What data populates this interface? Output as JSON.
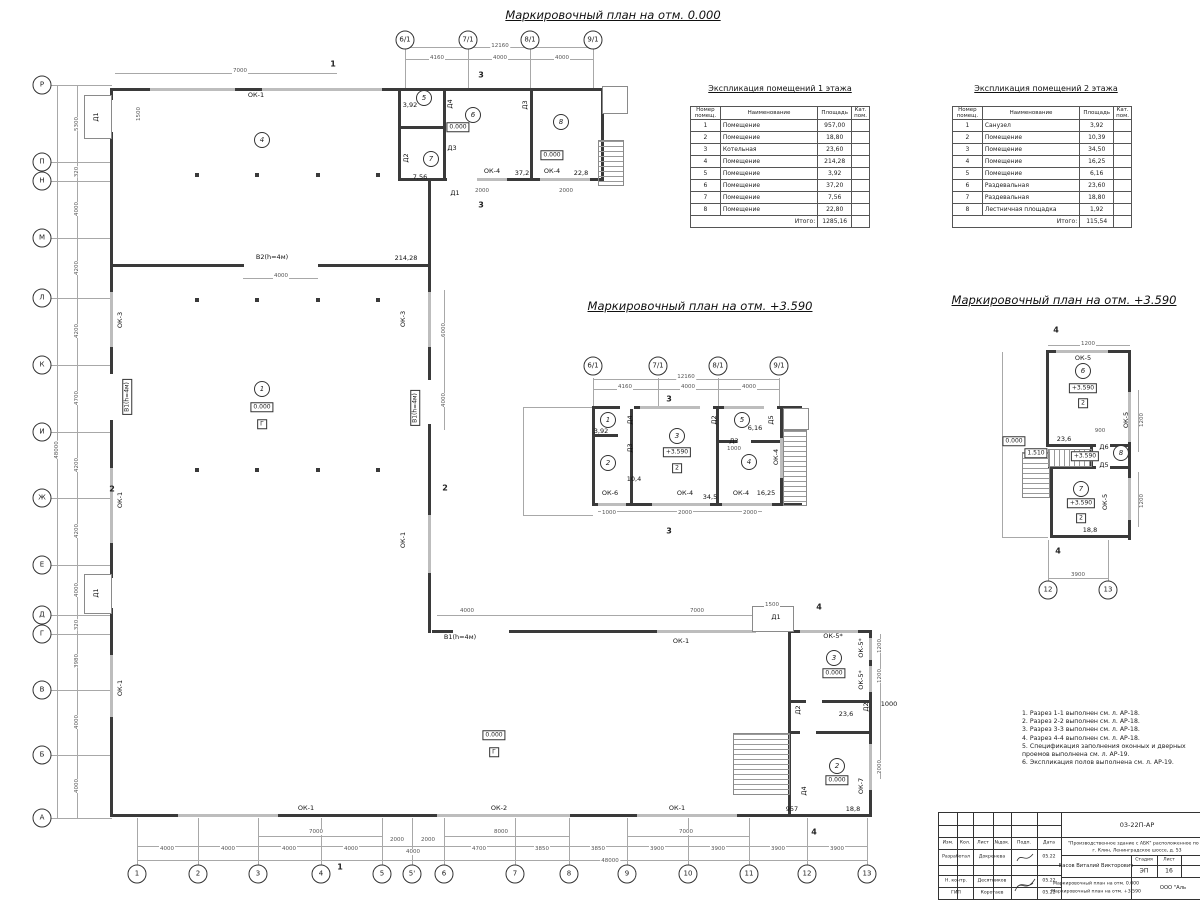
{
  "colors": {
    "wall": "#3a3a3a",
    "thin_line": "#a8a8a8",
    "window": "#bdbdbd",
    "dim_text": "#555555"
  },
  "plan_titles": {
    "main": "Маркировочный план на отм. 0.000",
    "mid": "Маркировочный план на отм. +3.590",
    "right": "Маркировочный план на отм. +3.590"
  },
  "axes": {
    "left_rows": [
      {
        "t": "Р",
        "x": 42,
        "y": 85
      },
      {
        "t": "П",
        "x": 42,
        "y": 162
      },
      {
        "t": "Н",
        "x": 42,
        "y": 181
      },
      {
        "t": "М",
        "x": 42,
        "y": 238
      },
      {
        "t": "Л",
        "x": 42,
        "y": 298
      },
      {
        "t": "К",
        "x": 42,
        "y": 365
      },
      {
        "t": "И",
        "x": 42,
        "y": 432
      },
      {
        "t": "Ж",
        "x": 42,
        "y": 498
      },
      {
        "t": "Е",
        "x": 42,
        "y": 565
      },
      {
        "t": "Д",
        "x": 42,
        "y": 615
      },
      {
        "t": "Г",
        "x": 42,
        "y": 634
      },
      {
        "t": "В",
        "x": 42,
        "y": 690
      },
      {
        "t": "Б",
        "x": 42,
        "y": 755
      },
      {
        "t": "А",
        "x": 42,
        "y": 818
      }
    ],
    "bottom_cols": [
      {
        "t": "1",
        "x": 137,
        "y": 874
      },
      {
        "t": "2",
        "x": 198,
        "y": 874
      },
      {
        "t": "3",
        "x": 258,
        "y": 874
      },
      {
        "t": "4",
        "x": 321,
        "y": 874
      },
      {
        "t": "5",
        "x": 382,
        "y": 874
      },
      {
        "t": "5'",
        "x": 412,
        "y": 874
      },
      {
        "t": "6",
        "x": 444,
        "y": 874
      },
      {
        "t": "7",
        "x": 515,
        "y": 874
      },
      {
        "t": "8",
        "x": 569,
        "y": 874
      },
      {
        "t": "9",
        "x": 627,
        "y": 874
      },
      {
        "t": "10",
        "x": 688,
        "y": 874
      },
      {
        "t": "11",
        "x": 749,
        "y": 874
      },
      {
        "t": "12",
        "x": 807,
        "y": 874
      },
      {
        "t": "13",
        "x": 867,
        "y": 874
      }
    ],
    "top_main": [
      {
        "t": "6/1",
        "x": 405,
        "y": 40
      },
      {
        "t": "7/1",
        "x": 468,
        "y": 40
      },
      {
        "t": "8/1",
        "x": 530,
        "y": 40
      },
      {
        "t": "9/1",
        "x": 593,
        "y": 40
      }
    ],
    "top_mid": [
      {
        "t": "6/1",
        "x": 593,
        "y": 366
      },
      {
        "t": "7/1",
        "x": 658,
        "y": 366
      },
      {
        "t": "8/1",
        "x": 718,
        "y": 366
      },
      {
        "t": "9/1",
        "x": 779,
        "y": 366
      }
    ],
    "right_bottom": [
      {
        "t": "12",
        "x": 1048,
        "y": 590
      },
      {
        "t": "13",
        "x": 1108,
        "y": 590
      }
    ]
  },
  "marks": {
    "labels_h": [
      {
        "t": "ОК-1",
        "x": 256,
        "y": 95
      },
      {
        "t": "В2(h=4м)",
        "x": 272,
        "y": 257
      },
      {
        "t": "214,28",
        "x": 406,
        "y": 258
      },
      {
        "t": "В1(h=4м)",
        "x": 460,
        "y": 637
      },
      {
        "t": "ОК-1",
        "x": 681,
        "y": 641
      },
      {
        "t": "ОК-1",
        "x": 306,
        "y": 808
      },
      {
        "t": "ОК-2",
        "x": 499,
        "y": 808
      },
      {
        "t": "ОК-1",
        "x": 677,
        "y": 808
      },
      {
        "t": "ОК-4",
        "x": 492,
        "y": 171
      },
      {
        "t": "37,2",
        "x": 522,
        "y": 173
      },
      {
        "t": "ОК-4",
        "x": 552,
        "y": 171
      },
      {
        "t": "22,8",
        "x": 581,
        "y": 173
      },
      {
        "t": "3,92",
        "x": 410,
        "y": 105
      },
      {
        "t": "7,56",
        "x": 420,
        "y": 177
      },
      {
        "t": "Д3",
        "x": 452,
        "y": 148
      },
      {
        "t": "Д1",
        "x": 455,
        "y": 193
      },
      {
        "t": "ОК-5*",
        "x": 833,
        "y": 636
      },
      {
        "t": "23,6",
        "x": 846,
        "y": 714
      },
      {
        "t": "18,8",
        "x": 853,
        "y": 809
      },
      {
        "t": "957",
        "x": 792,
        "y": 809
      },
      {
        "t": "Д1",
        "x": 776,
        "y": 617
      },
      {
        "t": "3,92",
        "x": 601,
        "y": 431
      },
      {
        "t": "10,4",
        "x": 634,
        "y": 479
      },
      {
        "t": "34,5",
        "x": 710,
        "y": 497
      },
      {
        "t": "ОК-6",
        "x": 610,
        "y": 493
      },
      {
        "t": "ОК-4",
        "x": 685,
        "y": 493
      },
      {
        "t": "ОК-4",
        "x": 741,
        "y": 493
      },
      {
        "t": "16,25",
        "x": 766,
        "y": 493
      },
      {
        "t": "6,16",
        "x": 755,
        "y": 428
      },
      {
        "t": "Д3",
        "x": 734,
        "y": 441
      },
      {
        "t": "ОК-5",
        "x": 1083,
        "y": 358
      },
      {
        "t": "23,6",
        "x": 1064,
        "y": 439
      },
      {
        "t": "Д6",
        "x": 1104,
        "y": 447
      },
      {
        "t": "Д5",
        "x": 1104,
        "y": 465
      },
      {
        "t": "18,8",
        "x": 1090,
        "y": 530
      },
      {
        "t": "1000",
        "x": 889,
        "y": 704
      }
    ],
    "labels_v": [
      {
        "t": "Д1",
        "x": 96,
        "y": 117
      },
      {
        "t": "ОК-3",
        "x": 120,
        "y": 320
      },
      {
        "t": "ОК-1",
        "x": 120,
        "y": 500
      },
      {
        "t": "Д1",
        "x": 96,
        "y": 593
      },
      {
        "t": "ОК-1",
        "x": 120,
        "y": 688
      },
      {
        "t": "ОК-3",
        "x": 403,
        "y": 319
      },
      {
        "t": "ОК-1",
        "x": 403,
        "y": 540
      },
      {
        "t": "Д4",
        "x": 450,
        "y": 104
      },
      {
        "t": "Д3",
        "x": 525,
        "y": 105
      },
      {
        "t": "Д2",
        "x": 406,
        "y": 158
      },
      {
        "t": "ОК-5*",
        "x": 861,
        "y": 648
      },
      {
        "t": "ОК-5*",
        "x": 861,
        "y": 680
      },
      {
        "t": "Д2",
        "x": 798,
        "y": 710
      },
      {
        "t": "Д2",
        "x": 866,
        "y": 707
      },
      {
        "t": "ОК-7",
        "x": 861,
        "y": 786
      },
      {
        "t": "Д4",
        "x": 804,
        "y": 791
      },
      {
        "t": "Д4",
        "x": 630,
        "y": 420
      },
      {
        "t": "Д3",
        "x": 630,
        "y": 448
      },
      {
        "t": "Д2",
        "x": 714,
        "y": 420
      },
      {
        "t": "Д5",
        "x": 771,
        "y": 420
      },
      {
        "t": "ОК-4",
        "x": 776,
        "y": 457
      },
      {
        "t": "ОК-5",
        "x": 1126,
        "y": 420
      },
      {
        "t": "ОК-5",
        "x": 1105,
        "y": 502
      }
    ],
    "boxes": [
      {
        "t": "0.000",
        "x": 262,
        "y": 407
      },
      {
        "t": "Г",
        "x": 262,
        "y": 424
      },
      {
        "t": "0.000",
        "x": 494,
        "y": 735
      },
      {
        "t": "Г",
        "x": 494,
        "y": 752
      },
      {
        "t": "0.000",
        "x": 458,
        "y": 127
      },
      {
        "t": "0.000",
        "x": 552,
        "y": 155
      },
      {
        "t": "0.000",
        "x": 834,
        "y": 673
      },
      {
        "t": "0.000",
        "x": 837,
        "y": 780
      },
      {
        "t": "+3.590",
        "x": 677,
        "y": 452
      },
      {
        "t": "2",
        "x": 677,
        "y": 468
      },
      {
        "t": "+3.590",
        "x": 1083,
        "y": 388
      },
      {
        "t": "2",
        "x": 1083,
        "y": 403
      },
      {
        "t": "0.000",
        "x": 1014,
        "y": 441
      },
      {
        "t": "1.510",
        "x": 1036,
        "y": 453
      },
      {
        "t": "+3.590",
        "x": 1085,
        "y": 456
      },
      {
        "t": "+3.590",
        "x": 1081,
        "y": 503
      },
      {
        "t": "2",
        "x": 1081,
        "y": 518
      }
    ],
    "vboxes": [
      {
        "t": "В1(h=4м)",
        "x": 127,
        "y": 397
      },
      {
        "t": "В1(h=4м)",
        "x": 415,
        "y": 408
      }
    ],
    "rooms": [
      {
        "t": "4",
        "x": 262,
        "y": 140
      },
      {
        "t": "1",
        "x": 262,
        "y": 389
      },
      {
        "t": "5",
        "x": 424,
        "y": 98
      },
      {
        "t": "6",
        "x": 473,
        "y": 115
      },
      {
        "t": "7",
        "x": 431,
        "y": 159
      },
      {
        "t": "8",
        "x": 561,
        "y": 122
      },
      {
        "t": "3",
        "x": 834,
        "y": 658
      },
      {
        "t": "2",
        "x": 837,
        "y": 766
      },
      {
        "t": "1",
        "x": 608,
        "y": 420
      },
      {
        "t": "2",
        "x": 608,
        "y": 463
      },
      {
        "t": "3",
        "x": 677,
        "y": 436
      },
      {
        "t": "4",
        "x": 749,
        "y": 462
      },
      {
        "t": "5",
        "x": 742,
        "y": 420
      },
      {
        "t": "6",
        "x": 1083,
        "y": 371
      },
      {
        "t": "7",
        "x": 1081,
        "y": 489
      },
      {
        "t": "8",
        "x": 1121,
        "y": 453
      }
    ],
    "sections": [
      {
        "t": "1",
        "x": 333,
        "y": 64
      },
      {
        "t": "1",
        "x": 340,
        "y": 867
      },
      {
        "t": "2",
        "x": 112,
        "y": 489
      },
      {
        "t": "2",
        "x": 445,
        "y": 488
      },
      {
        "t": "3",
        "x": 481,
        "y": 75
      },
      {
        "t": "3",
        "x": 481,
        "y": 205
      },
      {
        "t": "4",
        "x": 819,
        "y": 607
      },
      {
        "t": "4",
        "x": 814,
        "y": 832
      },
      {
        "t": "3",
        "x": 669,
        "y": 399
      },
      {
        "t": "3",
        "x": 669,
        "y": 531
      },
      {
        "t": "4",
        "x": 1056,
        "y": 330
      },
      {
        "t": "4",
        "x": 1058,
        "y": 551
      }
    ],
    "dims_h": [
      {
        "t": "12160",
        "x": 500,
        "y": 46
      },
      {
        "t": "4160",
        "x": 437,
        "y": 58
      },
      {
        "t": "4000",
        "x": 500,
        "y": 58
      },
      {
        "t": "4000",
        "x": 562,
        "y": 58
      },
      {
        "t": "7000",
        "x": 240,
        "y": 71
      },
      {
        "t": "4000",
        "x": 281,
        "y": 276
      },
      {
        "t": "7000",
        "x": 316,
        "y": 832
      },
      {
        "t": "8000",
        "x": 501,
        "y": 832
      },
      {
        "t": "7000",
        "x": 686,
        "y": 832
      },
      {
        "t": "4000",
        "x": 167,
        "y": 849
      },
      {
        "t": "4000",
        "x": 228,
        "y": 849
      },
      {
        "t": "4000",
        "x": 289,
        "y": 849
      },
      {
        "t": "4000",
        "x": 351,
        "y": 849
      },
      {
        "t": "2000",
        "x": 397,
        "y": 840
      },
      {
        "t": "2000",
        "x": 428,
        "y": 840
      },
      {
        "t": "4000",
        "x": 413,
        "y": 852
      },
      {
        "t": "4700",
        "x": 479,
        "y": 849
      },
      {
        "t": "3850",
        "x": 542,
        "y": 849
      },
      {
        "t": "3850",
        "x": 598,
        "y": 849
      },
      {
        "t": "3900",
        "x": 657,
        "y": 849
      },
      {
        "t": "3900",
        "x": 718,
        "y": 849
      },
      {
        "t": "3900",
        "x": 778,
        "y": 849
      },
      {
        "t": "3900",
        "x": 837,
        "y": 849
      },
      {
        "t": "48000",
        "x": 610,
        "y": 861
      },
      {
        "t": "4000",
        "x": 467,
        "y": 611
      },
      {
        "t": "7000",
        "x": 697,
        "y": 611
      },
      {
        "t": "1500",
        "x": 772,
        "y": 605
      },
      {
        "t": "2000",
        "x": 482,
        "y": 191
      },
      {
        "t": "2000",
        "x": 566,
        "y": 191
      },
      {
        "t": "12160",
        "x": 686,
        "y": 377
      },
      {
        "t": "4160",
        "x": 625,
        "y": 387
      },
      {
        "t": "4000",
        "x": 688,
        "y": 387
      },
      {
        "t": "4000",
        "x": 749,
        "y": 387
      },
      {
        "t": "1000",
        "x": 609,
        "y": 513
      },
      {
        "t": "2000",
        "x": 685,
        "y": 513
      },
      {
        "t": "2000",
        "x": 750,
        "y": 513
      },
      {
        "t": "1000",
        "x": 734,
        "y": 449
      },
      {
        "t": "1200",
        "x": 1088,
        "y": 344
      },
      {
        "t": "3900",
        "x": 1078,
        "y": 575
      },
      {
        "t": "900",
        "x": 1100,
        "y": 431
      }
    ],
    "dims_v": [
      {
        "t": "5300",
        "x": 77,
        "y": 124
      },
      {
        "t": "320",
        "x": 77,
        "y": 172
      },
      {
        "t": "4000",
        "x": 77,
        "y": 209
      },
      {
        "t": "4200",
        "x": 77,
        "y": 268
      },
      {
        "t": "4200",
        "x": 77,
        "y": 331
      },
      {
        "t": "4700",
        "x": 77,
        "y": 398
      },
      {
        "t": "4200",
        "x": 77,
        "y": 465
      },
      {
        "t": "4200",
        "x": 77,
        "y": 531
      },
      {
        "t": "4000",
        "x": 77,
        "y": 590
      },
      {
        "t": "320",
        "x": 77,
        "y": 625
      },
      {
        "t": "3980",
        "x": 77,
        "y": 661
      },
      {
        "t": "4000",
        "x": 77,
        "y": 722
      },
      {
        "t": "4000",
        "x": 77,
        "y": 786
      },
      {
        "t": "48000",
        "x": 57,
        "y": 450
      },
      {
        "t": "1500",
        "x": 139,
        "y": 114
      },
      {
        "t": "6000",
        "x": 444,
        "y": 330
      },
      {
        "t": "4000",
        "x": 444,
        "y": 400
      },
      {
        "t": "1200",
        "x": 880,
        "y": 646
      },
      {
        "t": "1200",
        "x": 880,
        "y": 676
      },
      {
        "t": "2000",
        "x": 880,
        "y": 767
      },
      {
        "t": "1200",
        "x": 1142,
        "y": 420
      },
      {
        "t": "1200",
        "x": 1142,
        "y": 501
      }
    ]
  },
  "table1": {
    "title": "Экспликация помещений 1 этажа",
    "headers": [
      "Номер помещ.",
      "Наименование",
      "Площадь",
      "Кат. пом."
    ],
    "rows": [
      [
        "1",
        "Помещение",
        "957,00",
        ""
      ],
      [
        "2",
        "Помещение",
        "18,80",
        ""
      ],
      [
        "3",
        "Котельная",
        "23,60",
        ""
      ],
      [
        "4",
        "Помещение",
        "214,28",
        ""
      ],
      [
        "5",
        "Помещение",
        "3,92",
        ""
      ],
      [
        "6",
        "Помещение",
        "37,20",
        ""
      ],
      [
        "7",
        "Помещение",
        "7,56",
        ""
      ],
      [
        "8",
        "Помещение",
        "22,80",
        ""
      ]
    ],
    "total_label": "Итого:",
    "total": "1285,16"
  },
  "table2": {
    "title": "Экспликация помещений 2 этажа",
    "headers": [
      "Номер помещ.",
      "Наименование",
      "Площадь",
      "Кат. пом."
    ],
    "rows": [
      [
        "1",
        "Санузел",
        "3,92",
        ""
      ],
      [
        "2",
        "Помещение",
        "10,39",
        ""
      ],
      [
        "3",
        "Помещение",
        "34,50",
        ""
      ],
      [
        "4",
        "Помещение",
        "16,25",
        ""
      ],
      [
        "5",
        "Помещение",
        "6,16",
        ""
      ],
      [
        "6",
        "Раздевальная",
        "23,60",
        ""
      ],
      [
        "7",
        "Раздевальная",
        "18,80",
        ""
      ],
      [
        "8",
        "Лестничная площадка",
        "1,92",
        ""
      ]
    ],
    "total_label": "Итого:",
    "total": "115,54"
  },
  "notes": {
    "items": [
      "1. Разрез 1-1 выполнен см. л. АР-18.",
      "2. Разрез 2-2 выполнен см. л. АР-18.",
      "3. Разрез 3-3 выполнен см. л. АР-18.",
      "4. Разрез 4-4 выполнен см. л. АР-18.",
      "5. Спецификация заполнения оконных и дверных проемов выполнена см. л. АР-19.",
      "6. Экспликация полов выполнена см. л. АР-19."
    ]
  },
  "stamp": {
    "code": "03-22П-АР",
    "object_line1": "\"Производственное здание с АБК\" расположенное по ад",
    "object_line2": "г. Клин, Ленинградское шоссе, д. 53",
    "chief": "Басов Виталий Викторович",
    "stage_label": "Стадия",
    "sheet_label": "Лист",
    "stage": "ЭП",
    "sheet": "16",
    "doc_line1": "Маркировочный план на отм. 0.000",
    "doc_line2": "Маркировочный план на отм. +3.590",
    "org": "ООО \"Аль",
    "col_headers": {
      "c1": "Изм.",
      "c2": "Кол.",
      "c3": "Лист",
      "c4": "№док.",
      "c5": "Подп.",
      "c6": "Дата"
    },
    "rows": [
      {
        "role": "Разработал",
        "name": "Докренева",
        "date": "05.22"
      },
      {
        "role": "Н. контр.",
        "name": "Десятников",
        "date": "05.22"
      },
      {
        "role": "ГИП",
        "name": "Коротаев",
        "date": "05.22"
      }
    ]
  }
}
